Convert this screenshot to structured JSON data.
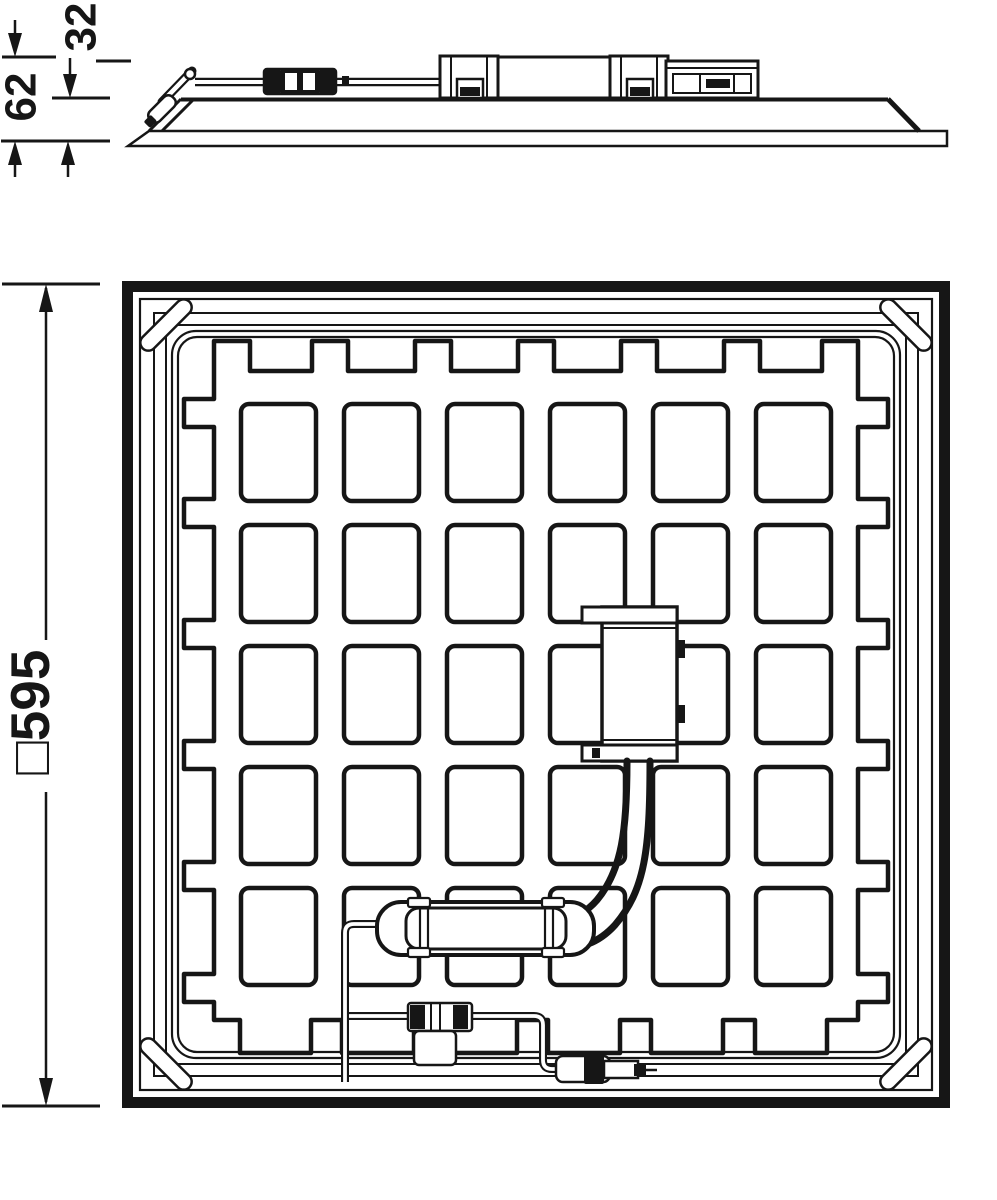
{
  "page": {
    "background": "#ffffff",
    "ink": "#161616",
    "kind": "luminaire-dimensional-drawing"
  },
  "figure": {
    "side_view": {
      "dim_height_total": "62",
      "dim_height_panel": "32"
    },
    "rear_view": {
      "dim_outline": "□595"
    }
  }
}
